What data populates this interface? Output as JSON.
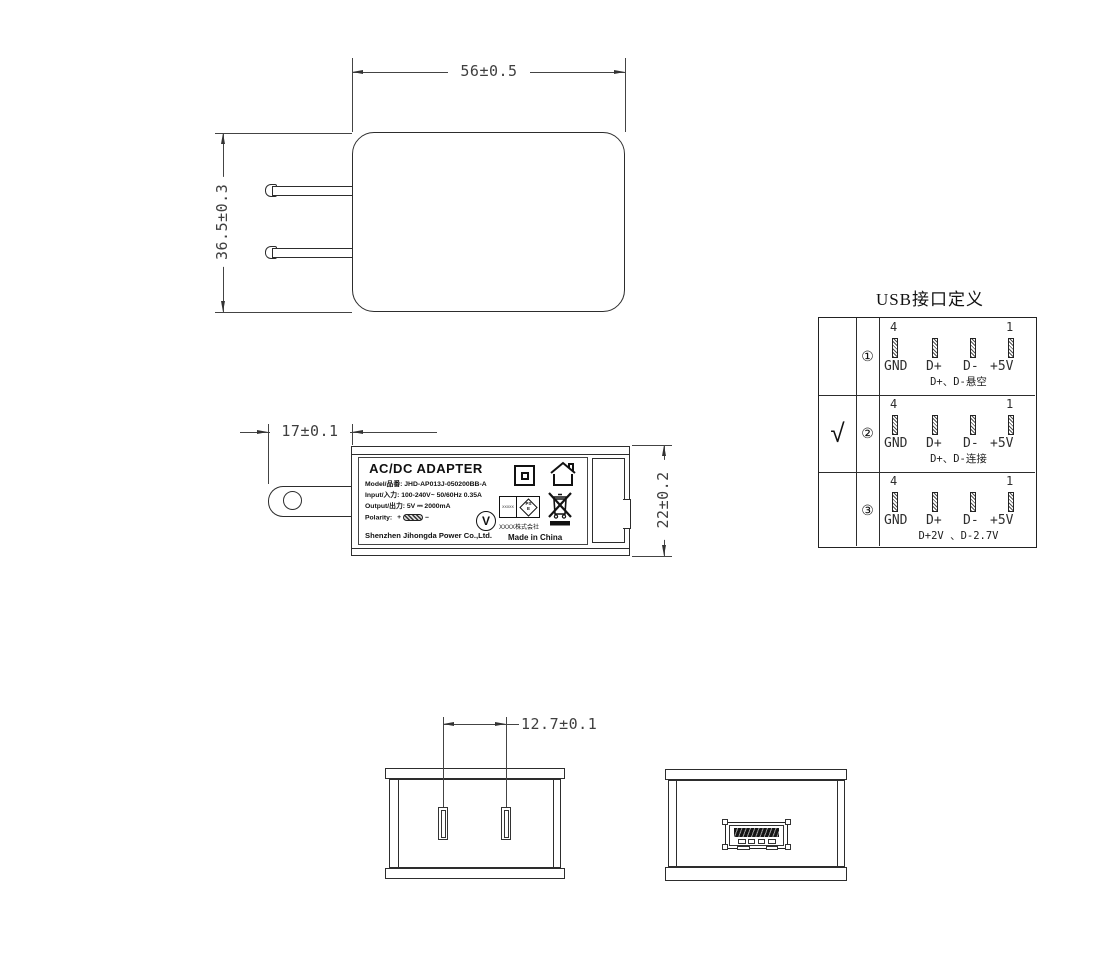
{
  "dimensions": {
    "top_width": "56±0.5",
    "top_height": "36.5±0.3",
    "prong_length": "17±0.1",
    "body_depth": "22±0.2",
    "pin_spacing": "12.7±0.1"
  },
  "label": {
    "title": "AC/DC  ADAPTER",
    "model": "Model/品番: JHD-AP013J-050200BB-A",
    "input": "Input/入力: 100-240V~  50/60Hz  0.35A",
    "output": "Output/出力: 5V ⎓ 2000mA",
    "polarity_label": "Polarity:",
    "polarity_plus": "+",
    "polarity_minus": "−",
    "company": "Shenzhen Jihongda Power Co.,Ltd.",
    "efficiency_mark": "V",
    "pse_left": "XXXXX",
    "pse_ps": "PS",
    "pse_e": "E",
    "cert_company": "XXXX株式会社",
    "made_in": "Made in China"
  },
  "usb_table": {
    "title": "USB接口定义",
    "pin_num_left": "4",
    "pin_num_right": "1",
    "pin_labels": [
      "GND",
      "D+",
      "D-",
      "+5V"
    ],
    "rows": [
      {
        "check": "",
        "index": "①",
        "note": "D+、D-悬空"
      },
      {
        "check": "√",
        "index": "②",
        "note": "D+、D-连接"
      },
      {
        "check": "",
        "index": "③",
        "note": "D+2V 、D-2.7V"
      }
    ]
  }
}
